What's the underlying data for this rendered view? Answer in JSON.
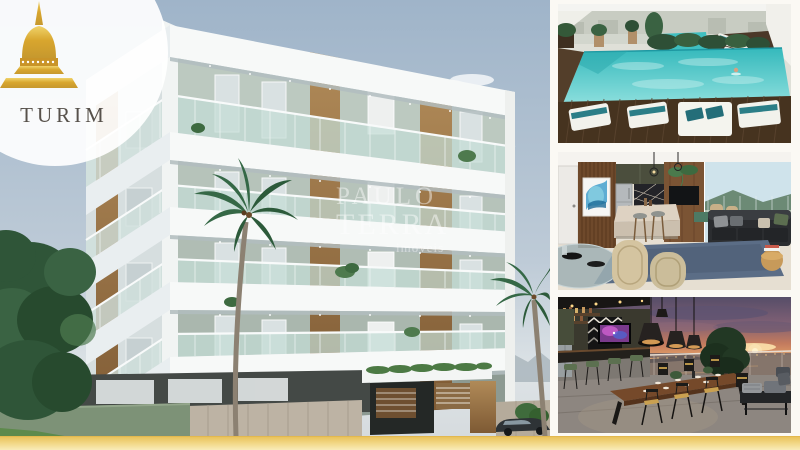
{
  "brand": {
    "name": "TURIM",
    "icon": "pagoda-icon",
    "gold_color": "#d8a62e",
    "name_color": "#57514b"
  },
  "watermark": {
    "line1": "PAULO",
    "line2": "TERRA",
    "line3": "imóveis"
  },
  "accent": {
    "gold_bar_top": "#e9c35c",
    "gold_bar_bottom": "#f8ecb8"
  },
  "gallery": {
    "main": {
      "name": "apartment-building-render"
    },
    "thumbs": [
      {
        "name": "rooftop-pool"
      },
      {
        "name": "living-room-kitchen"
      },
      {
        "name": "rooftop-terrace-sunset"
      }
    ]
  }
}
